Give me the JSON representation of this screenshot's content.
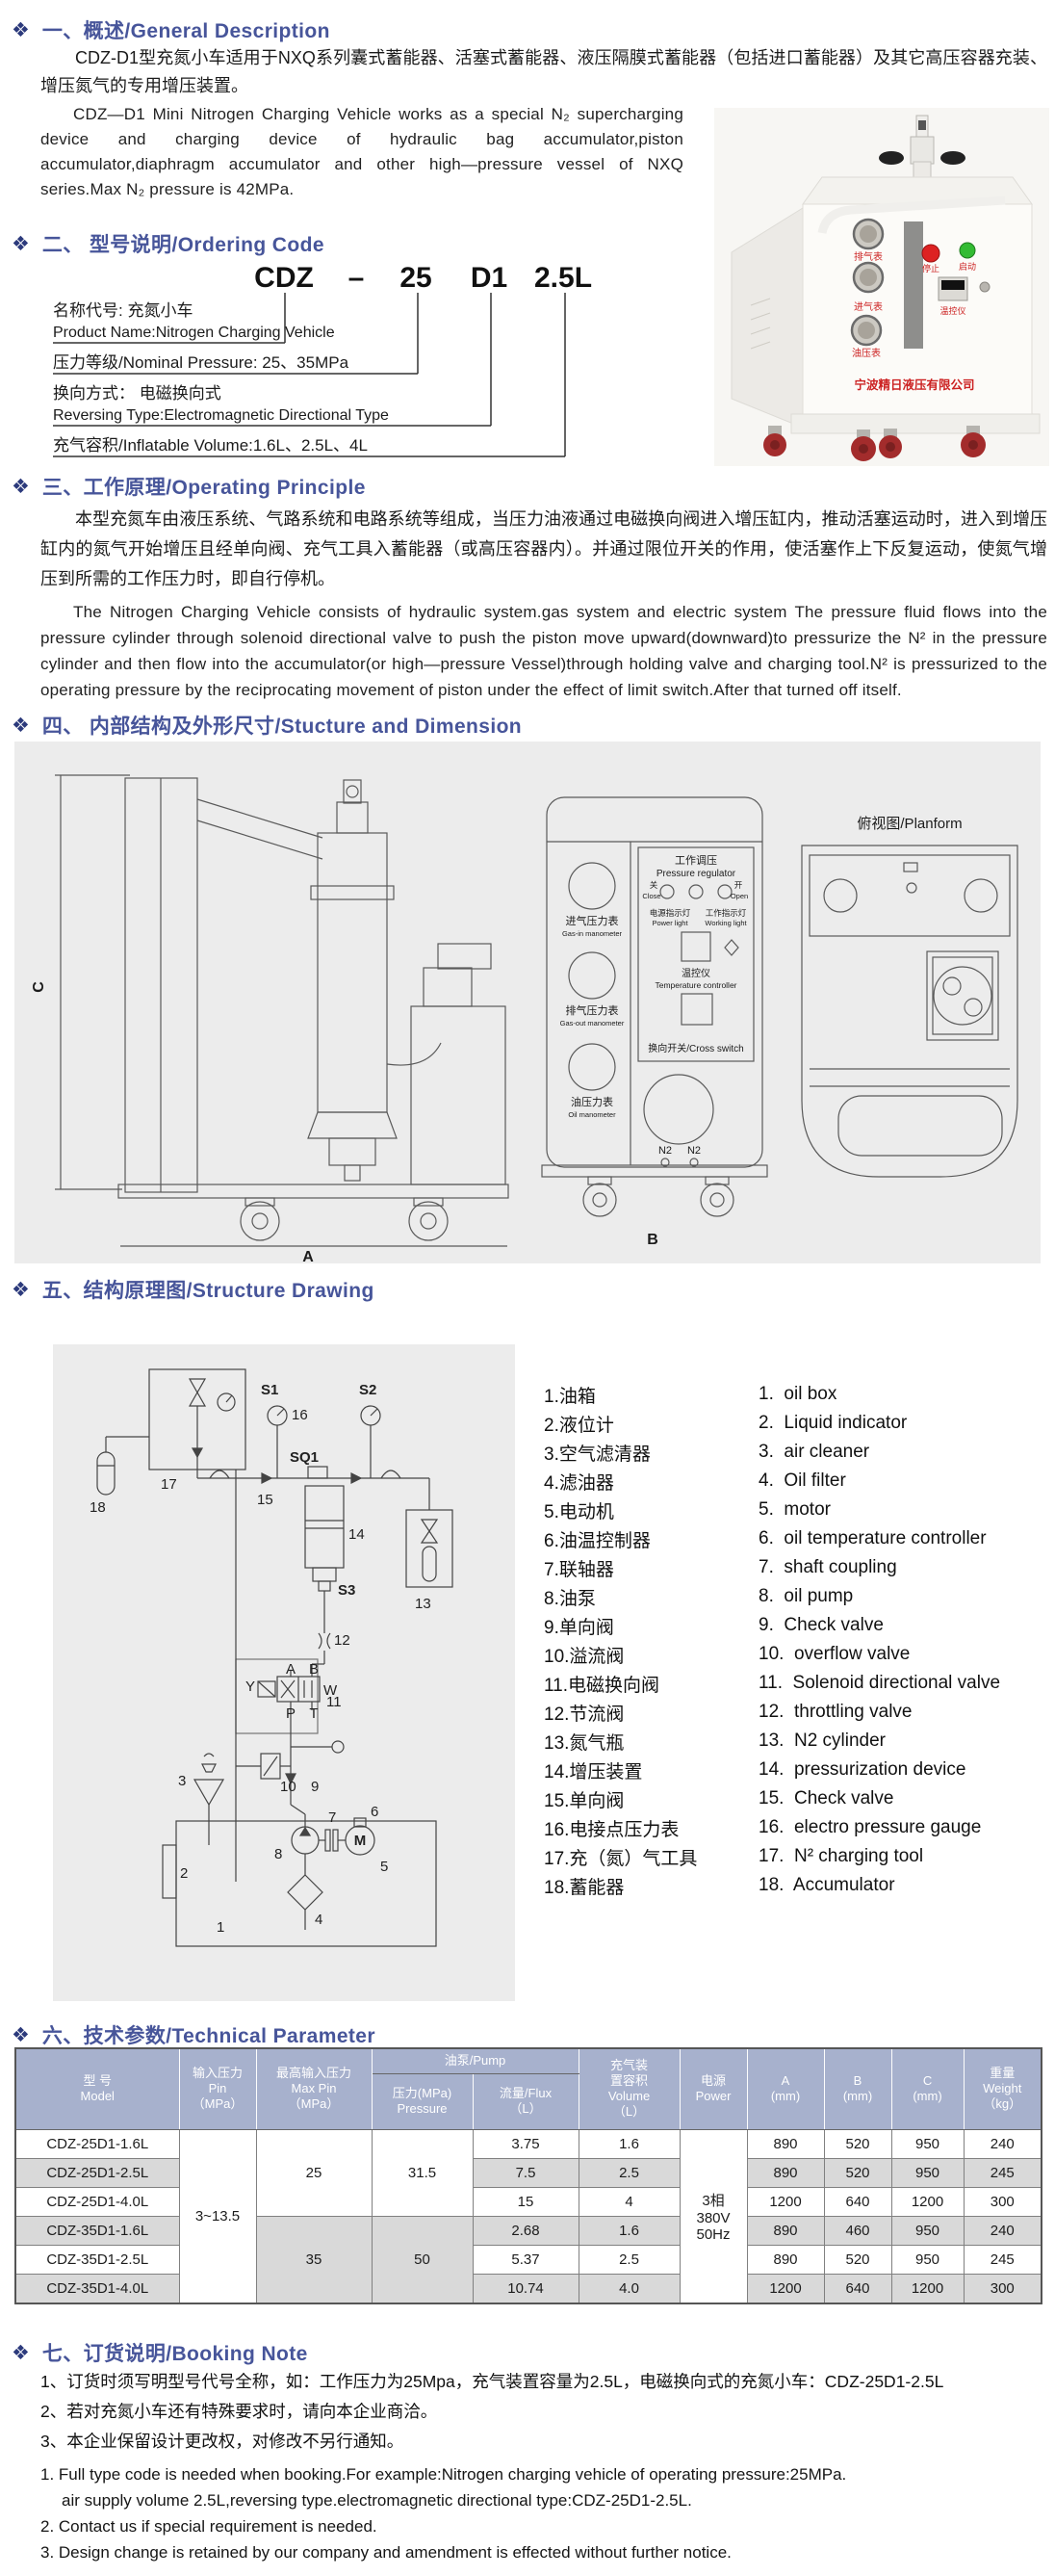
{
  "colors": {
    "accent": "#47559a",
    "icon_navy": "#2c3a7c",
    "table_header_bg": "#a7b1cd",
    "row_alt": "#d9d9d9",
    "panel_bg": "#ececec",
    "label_red": "#cc2222"
  },
  "sections": {
    "s1": {
      "title": "一、概述/General Description",
      "zh": "CDZ-D1型充氮小车适用于NXQ系列囊式蓄能器、活塞式蓄能器、液压隔膜式蓄能器（包括进口蓄能器）及其它高压容器充装、增压氮气的专用增压装置。",
      "en": "CDZ—D1 Mini Nitrogen Charging Vehicle works as a special N₂ supercharging device and charging device of hydraulic bag accumulator,piston accumulator,diaphragm accumulator and other high—pressure vessel of NXQ series.Max N₂ pressure is 42MPa."
    },
    "s2": {
      "title": "二、 型号说明/Ordering Code",
      "code": {
        "p1": "CDZ",
        "dash": "–",
        "p2": "25",
        "p3": "D1",
        "p4": "2.5L"
      },
      "rows": {
        "r1a": "名称代号: 充氮小车",
        "r1b": "Product Name:Nitrogen Charging Vehicle",
        "r2a": "压力等级/Nominal Pressure: 25、35MPa",
        "r3a": "换向方式： 电磁换向式",
        "r3b": "Reversing Type:Electromagnetic Directional Type",
        "r4a": "充气容积/Inflatable Volume:1.6L、2.5L、4L"
      }
    },
    "s3": {
      "title": "三、工作原理/Operating Principle",
      "zh": "本型充氮车由液压系统、气路系统和电路系统等组成，当压力油液通过电磁换向阀进入增压缸内，推动活塞运动时，进入到增压缸内的氮气开始增压且经单向阀、充气工具入蓄能器（或高压容器内）。并通过限位开关的作用，使活塞作上下反复运动，使氮气增压到所需的工作压力时，即自行停机。",
      "en": "The Nitrogen Charging Vehicle consists of hydraulic system.gas system and electric system The pressure fluid flows into the pressure cylinder through solenoid directional valve to push the piston move upward(downward)to pressurize the N² in the pressure cylinder and then flow into the accumulator(or high—pressure Vessel)through holding valve and charging tool.N² is pressurized to the operating pressure by the reciprocating movement of piston under the effect of limit switch.After that turned off itself."
    },
    "s4": {
      "title": "四、 内部结构及外形尺寸/Stucture and Dimension",
      "drawing": {
        "planform": "俯视图/Planform",
        "dim_a": "A",
        "dim_b": "B",
        "dim_c": "C",
        "pr_zh": "工作调压",
        "pr_en": "Pressure regulator",
        "close_zh": "关",
        "close_en": "Close",
        "open_zh": "开",
        "open_en": "Open",
        "power_zh": "电源指示灯",
        "power_en": "Power light",
        "work_zh": "工作指示灯",
        "work_en": "Working light",
        "temp_zh": "温控仪",
        "temp_en": "Temperature controller",
        "cross": "换向开关/Cross switch",
        "gas_in_zh": "进气压力表",
        "gas_in_en": "Gas-in manometer",
        "gas_out_zh": "排气压力表",
        "gas_out_en": "Gas-out manometer",
        "oil_zh": "油压力表",
        "oil_en": "Oil manometer",
        "n2": "N2"
      }
    },
    "s5": {
      "title": "五、结构原理图/Structure Drawing",
      "parts_zh": [
        "1.油箱",
        "2.液位计",
        "3.空气滤清器",
        "4.滤油器",
        "5.电动机",
        "6.油温控制器",
        "7.联轴器",
        "8.油泵",
        "9.单向阀",
        "10.溢流阀",
        "11.电磁换向阀",
        "12.节流阀",
        "13.氮气瓶",
        "14.增压装置",
        "15.单向阀",
        "16.电接点压力表",
        "17.充（氮）气工具",
        "18.蓄能器"
      ],
      "parts_en": [
        "1.  oil box",
        "2.  Liquid indicator",
        "3.  air cleaner",
        "4.  Oil filter",
        "5.  motor",
        "6.  oil temperature controller",
        "7.  shaft coupling",
        "8.  oil pump",
        "9.  Check valve",
        "10.  overflow valve",
        "11.  Solenoid directional valve",
        "12.  throttling valve",
        "13.  N2 cylinder",
        "14.  pressurization device",
        "15.  Check valve",
        "16.  electro pressure gauge",
        "17.  N² charging tool",
        "18.  Accumulator"
      ],
      "labels": {
        "l18": "18",
        "l17": "17",
        "s1": "S1",
        "l16": "16",
        "s2": "S2",
        "sq1": "SQ1",
        "l15": "15",
        "l14": "14",
        "l13": "13",
        "s3": "S3",
        "l12": "12",
        "l11": "11",
        "l10": "10",
        "l9": "9",
        "l3": "3",
        "l2": "2",
        "l1": "1",
        "l8": "8",
        "l7": "7",
        "l6": "6",
        "l5": "5",
        "l4": "4",
        "m": "M",
        "pa": "A",
        "pb": "B",
        "pp": "P",
        "pt": "T",
        "py": "Y",
        "pw": "W"
      }
    },
    "s6": {
      "title": "六、技术参数/Technical Parameter",
      "table": {
        "headers": {
          "model": "型  号\nModel",
          "pin": "输入压力\nPin\n（MPa）",
          "max_pin": "最高输入压力\nMax Pin\n（MPa）",
          "pump": "油泵/Pump",
          "pressure": "压力(MPa)\nPressure",
          "flux": "流量/Flux\n（L）",
          "volume": "充气装\n置容积\nVolume\n（L）",
          "power": "电源\nPower",
          "a": "A\n(mm)",
          "b": "B\n(mm)",
          "c": "C\n(mm)",
          "weight": "重量\nWeight\n（kg）"
        },
        "spans": {
          "pin": "3~13.5",
          "max_pin_25": "25",
          "max_pin_35": "35",
          "pressure_25": "31.5",
          "pressure_35": "50",
          "power": "3相\n380V\n50Hz"
        },
        "rows": [
          {
            "model": "CDZ-25D1-1.6L",
            "flux": "3.75",
            "volume": "1.6",
            "a": "890",
            "b": "520",
            "c": "950",
            "weight": "240"
          },
          {
            "model": "CDZ-25D1-2.5L",
            "flux": "7.5",
            "volume": "2.5",
            "a": "890",
            "b": "520",
            "c": "950",
            "weight": "245"
          },
          {
            "model": "CDZ-25D1-4.0L",
            "flux": "15",
            "volume": "4",
            "a": "1200",
            "b": "640",
            "c": "1200",
            "weight": "300"
          },
          {
            "model": "CDZ-35D1-1.6L",
            "flux": "2.68",
            "volume": "1.6",
            "a": "890",
            "b": "460",
            "c": "950",
            "weight": "240"
          },
          {
            "model": "CDZ-35D1-2.5L",
            "flux": "5.37",
            "volume": "2.5",
            "a": "890",
            "b": "520",
            "c": "950",
            "weight": "245"
          },
          {
            "model": "CDZ-35D1-4.0L",
            "flux": "10.74",
            "volume": "4.0",
            "a": "1200",
            "b": "640",
            "c": "1200",
            "weight": "300"
          }
        ]
      }
    },
    "s7": {
      "title": "七、订货说明/Booking Note",
      "notes_zh": [
        "1、订货时须写明型号代号全称，如：工作压力为25Mpa，充气装置容量为2.5L，电磁换向式的充氮小车：CDZ-25D1-2.5L",
        "2、若对充氮小车还有特殊要求时，请向本企业商洽。",
        "3、本企业保留设计更改权，对修改不另行通知。"
      ],
      "notes_en": [
        "1. Full type code is needed when booking.For example:Nitrogen charging vehicle of operating pressure:25MPa.",
        "air supply volume 2.5L,reversing type.electromagnetic directional type:CDZ-25D1-2.5L.",
        "2. Contact us if special requirement is needed.",
        "3. Design change is retained by our company and amendment is effected without further notice."
      ]
    }
  },
  "photo": {
    "gauge1": "排气表",
    "gauge2": "进气表",
    "gauge3": "油压表",
    "stop": "停止",
    "start": "启动",
    "temp": "温控仪",
    "company": "宁波精日液压有限公司"
  }
}
